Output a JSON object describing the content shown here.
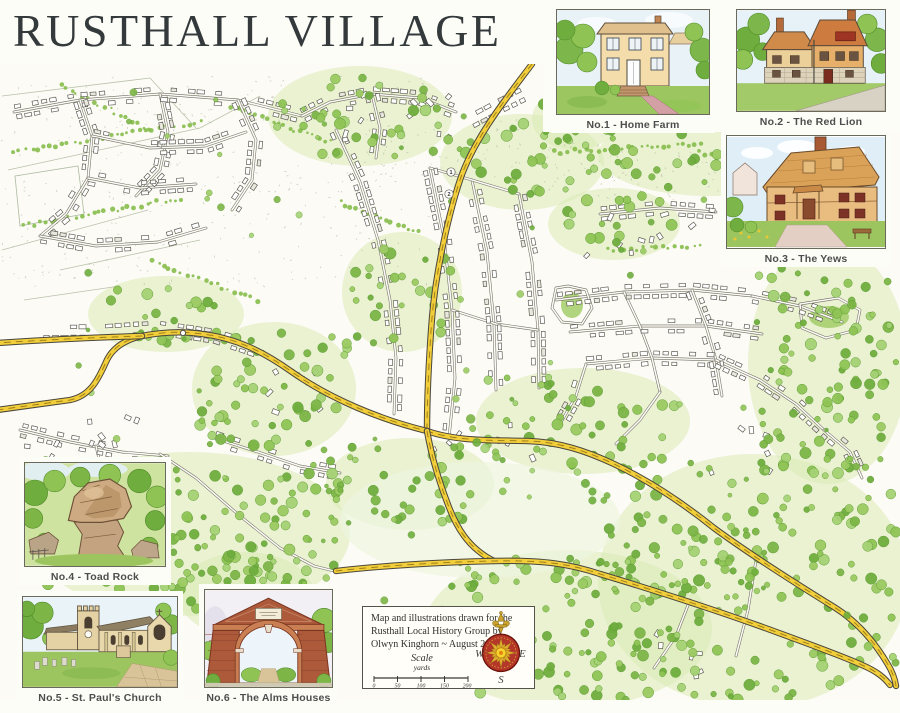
{
  "title": "RUSTHALL VILLAGE",
  "insets": [
    {
      "caption": "No.1 - Home Farm"
    },
    {
      "caption": "No.2 - The Red Lion"
    },
    {
      "caption": "No.3 - The Yews"
    },
    {
      "caption": "No.4 - Toad Rock"
    },
    {
      "caption": "No.5 - St. Paul's Church"
    },
    {
      "caption": "No.6 - The Alms Houses"
    }
  ],
  "credit": {
    "line1": "Map and illustrations drawn for the",
    "line2": "Rusthall Local History Group by",
    "line3": "Olwyn Kinghorn ~ August 2008."
  },
  "scale": {
    "label": "Scale",
    "unit": "yards",
    "ticks": [
      "0",
      "50",
      "100",
      "150",
      "200"
    ]
  },
  "compass": {
    "west": "W",
    "east": "E",
    "south": "S",
    "north_icon": "fleur-de-lis"
  },
  "map_markers": [
    {
      "label": "1"
    },
    {
      "label": "2"
    }
  ],
  "colors": {
    "paper": "#fcfbf5",
    "road_yellow": "#f2cf3a",
    "road_casing": "#4a463c",
    "road_centerline": "#b5790e",
    "tree_green": "#8fc455",
    "woodland_dark": "#6fae3e",
    "title_ink": "#343a3b",
    "caption_ink": "#4d4d4d",
    "compass_red": "#b5372a",
    "compass_gold": "#e0ae2d"
  }
}
